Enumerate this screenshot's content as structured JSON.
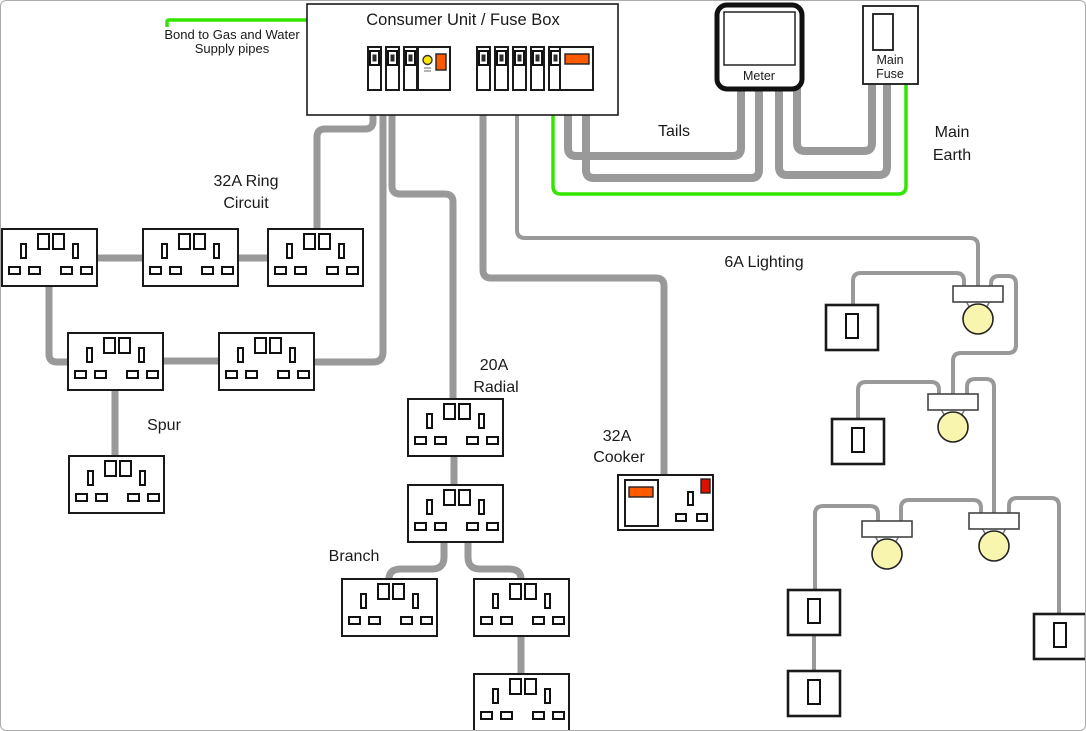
{
  "diagram": {
    "title": "Consumer Unit / Fuse Box",
    "labels": {
      "bond_line1": "Bond to Gas and Water",
      "bond_line2": "Supply pipes",
      "tails": "Tails",
      "main_earth_line1": "Main",
      "main_earth_line2": "Earth",
      "ring_line1": "32A Ring",
      "ring_line2": "Circuit",
      "spur": "Spur",
      "radial_line1": "20A",
      "radial_line2": "Radial",
      "branch": "Branch",
      "cooker_line1": "32A",
      "cooker_line2": "Cooker",
      "lighting": "6A Lighting",
      "meter": "Meter",
      "main_fuse_line1": "Main",
      "main_fuse_line2": "Fuse"
    },
    "colors": {
      "wire_gray": "#999999",
      "earth_green": "#33e600",
      "bulb_yellow": "#f8f6ae",
      "switch_orange": "#ff5a00",
      "indicator_red": "#dd1100",
      "test_button_yellow": "#ffe800"
    },
    "components": {
      "sockets": [
        {
          "id": "ring-socket-1",
          "x": 1,
          "y": 228
        },
        {
          "id": "ring-socket-2",
          "x": 142,
          "y": 228
        },
        {
          "id": "ring-socket-3",
          "x": 267,
          "y": 228
        },
        {
          "id": "ring-socket-4",
          "x": 67,
          "y": 332
        },
        {
          "id": "ring-socket-5",
          "x": 218,
          "y": 332
        },
        {
          "id": "spur-socket",
          "x": 68,
          "y": 455
        },
        {
          "id": "radial-socket-1",
          "x": 407,
          "y": 398
        },
        {
          "id": "radial-socket-2",
          "x": 407,
          "y": 484
        },
        {
          "id": "branch-socket-left",
          "x": 341,
          "y": 578
        },
        {
          "id": "branch-socket-right",
          "x": 473,
          "y": 578
        },
        {
          "id": "branch-socket-bottom",
          "x": 473,
          "y": 673
        }
      ],
      "switches": [
        {
          "id": "light-switch-1",
          "x": 825,
          "y": 304
        },
        {
          "id": "light-switch-2",
          "x": 831,
          "y": 418
        },
        {
          "id": "light-switch-3",
          "x": 787,
          "y": 589
        },
        {
          "id": "light-switch-4",
          "x": 787,
          "y": 670
        },
        {
          "id": "light-switch-5",
          "x": 1033,
          "y": 613
        }
      ],
      "lights": [
        {
          "id": "ceiling-light-1",
          "x": 952,
          "y": 285
        },
        {
          "id": "ceiling-light-2",
          "x": 927,
          "y": 393
        },
        {
          "id": "ceiling-light-3",
          "x": 861,
          "y": 520
        },
        {
          "id": "ceiling-light-4",
          "x": 968,
          "y": 512
        }
      ],
      "breakers": [
        {
          "id": "mcb-1",
          "x": 367,
          "y": 46
        },
        {
          "id": "mcb-2",
          "x": 385,
          "y": 46
        },
        {
          "id": "mcb-3",
          "x": 403,
          "y": 46
        },
        {
          "id": "mcb-4",
          "x": 476,
          "y": 46
        },
        {
          "id": "mcb-5",
          "x": 494,
          "y": 46
        },
        {
          "id": "mcb-6",
          "x": 512,
          "y": 46
        },
        {
          "id": "mcb-7",
          "x": 530,
          "y": 46
        },
        {
          "id": "mcb-8",
          "x": 548,
          "y": 46
        }
      ]
    }
  }
}
